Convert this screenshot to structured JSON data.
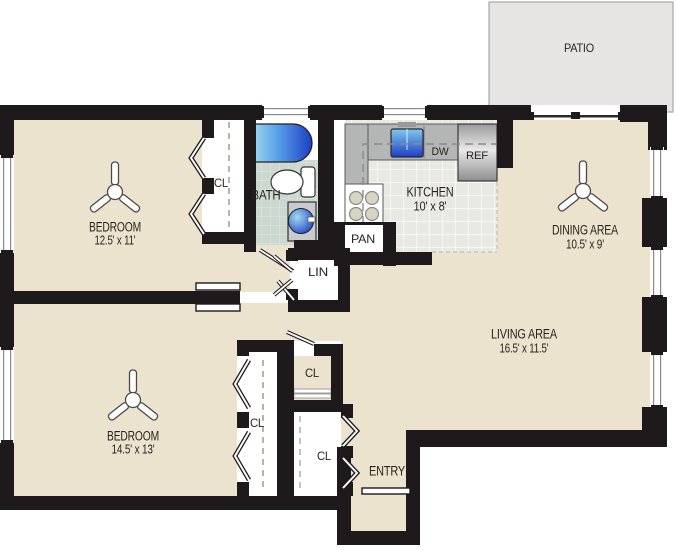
{
  "rooms": {
    "bedroom1": {
      "name": "BEDROOM",
      "dims": "12.5' x 11'"
    },
    "bedroom2": {
      "name": "BEDROOM",
      "dims": "14.5' x 13'"
    },
    "dining": {
      "name": "DINING AREA",
      "dims": "10.5' x 9'"
    },
    "living": {
      "name": "LIVING AREA",
      "dims": "16.5' x 11.5'"
    },
    "kitchen": {
      "name": "KITCHEN",
      "dims": "10' x 8'"
    },
    "bath": {
      "name": "BATH"
    },
    "patio": {
      "name": "PATIO"
    },
    "entry": {
      "name": "ENTRY"
    }
  },
  "closets": {
    "closet": "CL",
    "linen": "LIN",
    "pantry": "PAN"
  },
  "appliances": {
    "dishwasher": "DW",
    "refrigerator": "REF"
  },
  "colors": {
    "wall": "#1e191b",
    "floor": "#ebe3cd",
    "patio_fill": "#e6e5e3",
    "patio_border": "#a8a8a8",
    "bath_tile": "#ccd8cf",
    "kitchen_tile": "#e9e9e4",
    "counter": "#b4b5b5",
    "fixture_blue_light": "#9fd9f0",
    "fixture_blue_dark": "#1e3ec4",
    "detail_gray": "#8a8a8a"
  }
}
